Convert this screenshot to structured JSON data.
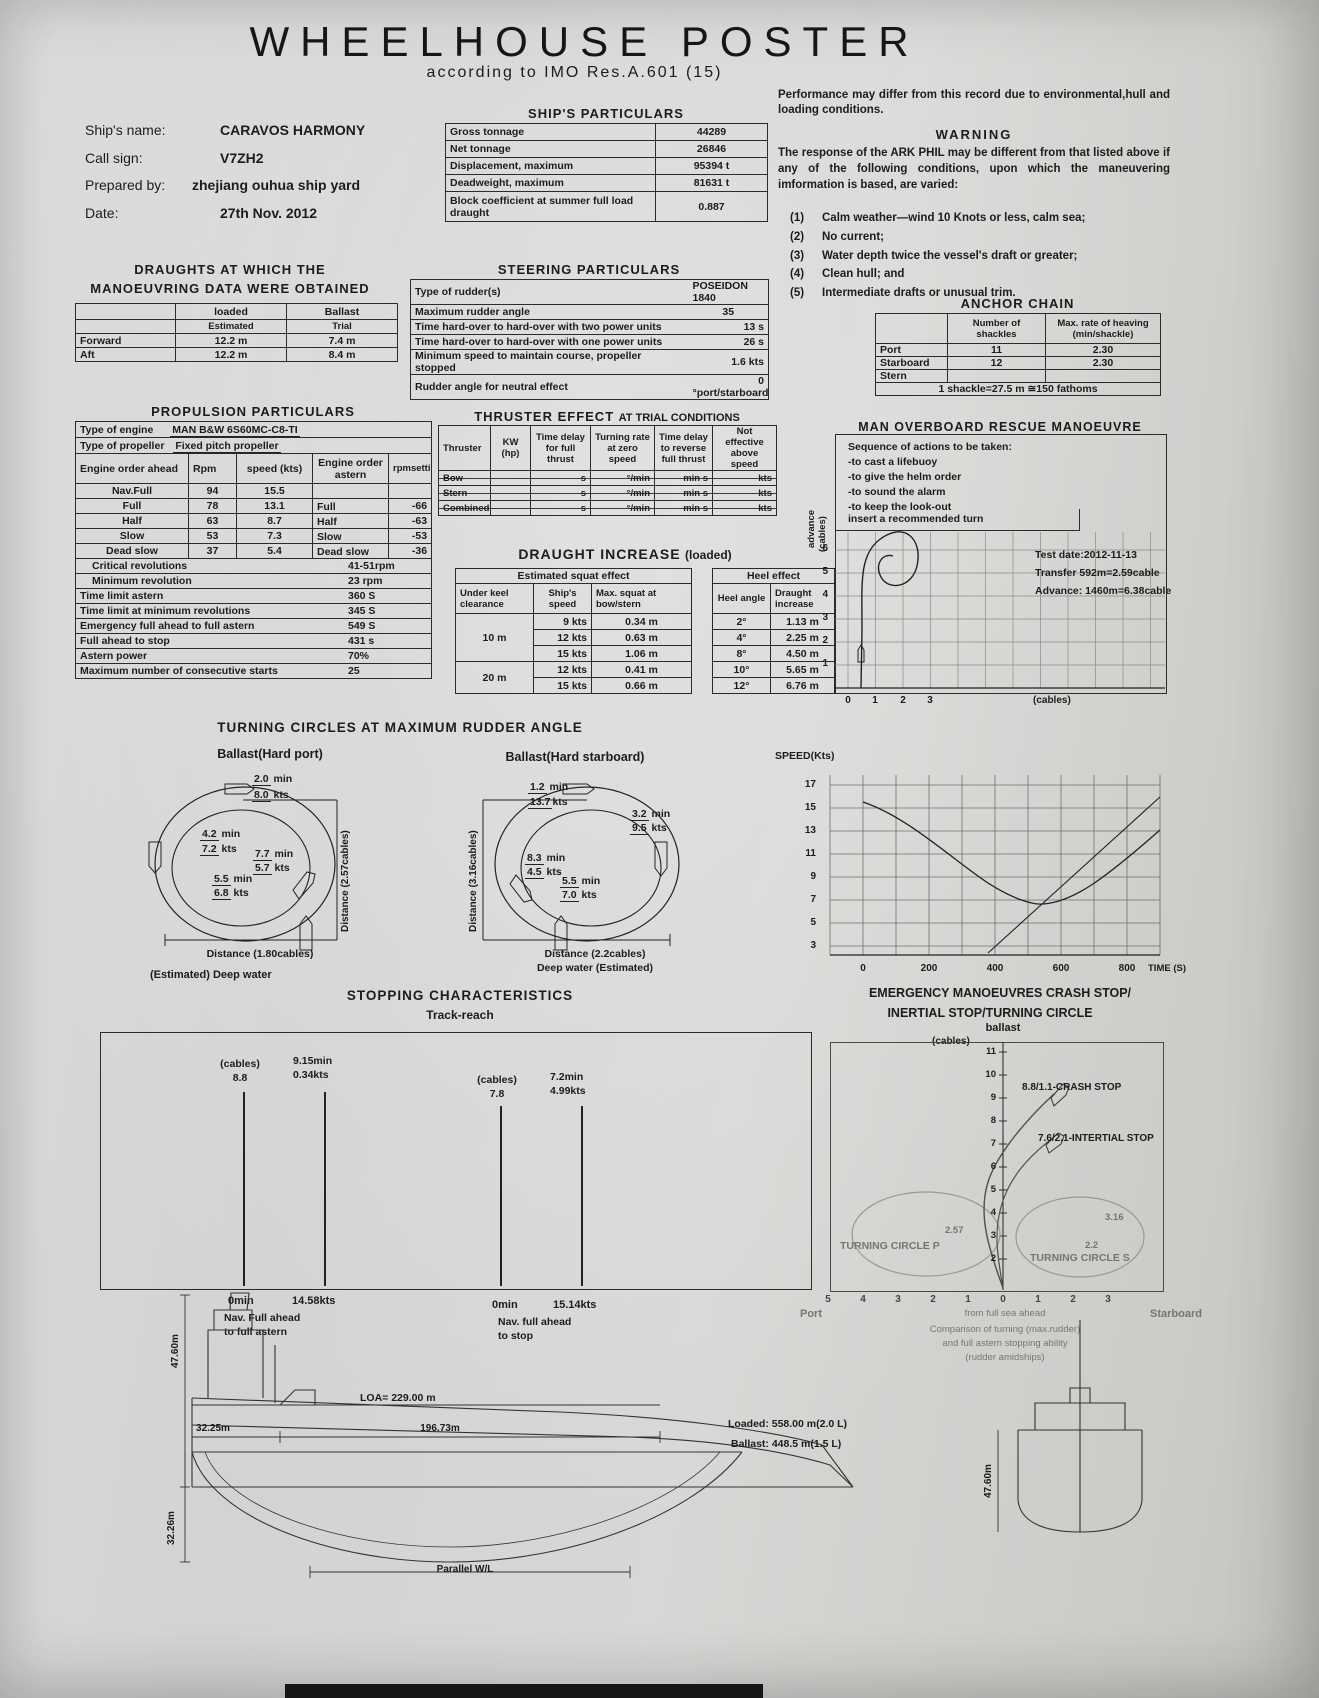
{
  "header": {
    "title": "WHEELHOUSE POSTER",
    "subtitle": "according to IMO Res.A.601 (15)"
  },
  "notes": {
    "performance": "Performance may differ from this record due to environmental,hull and loading conditions."
  },
  "ship_info": {
    "rows": [
      {
        "label": "Ship's name:",
        "value": "CARAVOS HARMONY"
      },
      {
        "label": "Call sign:",
        "value": "V7ZH2"
      },
      {
        "label": "Prepared by:",
        "value": "zhejiang ouhua ship yard"
      },
      {
        "label": "Date:",
        "value": "27th Nov. 2012"
      }
    ]
  },
  "particulars": {
    "title": "SHIP'S PARTICULARS",
    "rows": [
      {
        "label": "Gross tonnage",
        "value": "44289"
      },
      {
        "label": "Net tonnage",
        "value": "26846"
      },
      {
        "label": "Displacement, maximum",
        "value": "95394 t"
      },
      {
        "label": "Deadweight, maximum",
        "value": "81631 t"
      },
      {
        "label": "Block coefficient at summer full load draught",
        "value": "0.887"
      }
    ]
  },
  "warning": {
    "title": "WARNING",
    "body": "The response of the ARK PHIL may be different from that listed above if any of the following conditions, upon which the maneuvering imformation is based, are varied:",
    "items": [
      {
        "num": "(1)",
        "text": "Calm weather—wind 10 Knots or less, calm sea;"
      },
      {
        "num": "(2)",
        "text": "No current;"
      },
      {
        "num": "(3)",
        "text": "Water depth twice the vessel's draft or greater;"
      },
      {
        "num": "(4)",
        "text": "Clean hull; and"
      },
      {
        "num": "(5)",
        "text": "Intermediate drafts or unusual trim."
      }
    ]
  },
  "draughts": {
    "title1": "DRAUGHTS AT WHICH THE",
    "title2": "MANOEUVRING DATA WERE OBTAINED",
    "col_loaded": "loaded",
    "col_ballast": "Ballast",
    "sub_loaded": "Estimated",
    "sub_ballast": "Trial",
    "rows": [
      {
        "label": "Forward",
        "loaded": "12.2  m",
        "ballast": "7.4  m"
      },
      {
        "label": "Aft",
        "loaded": "12.2  m",
        "ballast": "8.4  m"
      }
    ]
  },
  "steering": {
    "title": "STEERING PARTICULARS",
    "rows": [
      {
        "label": "Type of rudder(s)",
        "value": "POSEIDON 1840"
      },
      {
        "label": "Maximum rudder angle",
        "value": "35"
      },
      {
        "label": "Time hard-over to hard-over with two power units",
        "value": "13  s"
      },
      {
        "label": "Time hard-over to hard-over with one power units",
        "value": "26  s"
      },
      {
        "label": "Minimum speed to maintain course, propeller stopped",
        "value": "1.6 kts"
      },
      {
        "label": "Rudder angle for neutral effect",
        "value": "0 °port/starboard"
      }
    ]
  },
  "anchor": {
    "title": "ANCHOR CHAIN",
    "col_shackles": "Number of shackles",
    "col_rate": "Max. rate of heaving (min/shackle)",
    "rows": [
      {
        "label": "Port",
        "shackles": "11",
        "rate": "2.30"
      },
      {
        "label": "Starboard",
        "shackles": "12",
        "rate": "2.30"
      },
      {
        "label": "Stern",
        "shackles": "",
        "rate": ""
      }
    ],
    "footer": "1 shackle=27.5 m ≅150 fathoms"
  },
  "propulsion": {
    "title": "PROPULSION PARTICULARS",
    "engine_label": "Type of engine",
    "engine": "MAN B&W 6S60MC-C8-TI",
    "propeller_label": "Type of propeller",
    "propeller": "Fixed pitch propeller",
    "col_ahead": "Engine order ahead",
    "col_rpm": "Rpm",
    "col_speed": "speed (kts)",
    "col_astern": "Engine order astern",
    "col_rpmset": "rpmsetting",
    "ahead_rows": [
      {
        "order": "Nav.Full",
        "rpm": "94",
        "speed": "15.5",
        "astern": "",
        "rpmset": ""
      },
      {
        "order": "Full",
        "rpm": "78",
        "speed": "13.1",
        "astern": "Full",
        "rpmset": "-66"
      },
      {
        "order": "Half",
        "rpm": "63",
        "speed": "8.7",
        "astern": "Half",
        "rpmset": "-63"
      },
      {
        "order": "Slow",
        "rpm": "53",
        "speed": "7.3",
        "astern": "Slow",
        "rpmset": "-53"
      },
      {
        "order": "Dead slow",
        "rpm": "37",
        "speed": "5.4",
        "astern": "Dead slow",
        "rpmset": "-36"
      }
    ],
    "extra_rows": [
      {
        "label": "Critical revolutions",
        "value": "41-51rpm"
      },
      {
        "label": "Minimum revolution",
        "value": "23 rpm"
      },
      {
        "label": "Time limit astern",
        "value": "360 S"
      },
      {
        "label": "Time limit at minimum revolutions",
        "value": "345 S"
      },
      {
        "label": "Emergency full ahead to full astern",
        "value": "549 S"
      },
      {
        "label": "Full ahead to stop",
        "value": "431 s"
      },
      {
        "label": "Astern power",
        "value": "70%"
      },
      {
        "label": "Maximum number of consecutive starts",
        "value": "25"
      }
    ]
  },
  "thruster": {
    "title": "THRUSTER EFFECT",
    "title2": "AT TRIAL CONDITIONS",
    "cols": [
      "Thruster",
      "KW (hp)",
      "Time delay for full thrust",
      "Turning rate at zero speed",
      "Time delay to reverse full thrust",
      "Not effective above speed"
    ],
    "rows": [
      {
        "name": "Bow",
        "delay": "s",
        "rate": "°/min",
        "reverse": "min  s",
        "speed": "kts"
      },
      {
        "name": "Stern",
        "delay": "s",
        "rate": "°/min",
        "reverse": "min  s",
        "speed": "kts"
      },
      {
        "name": "Combined",
        "delay": "s",
        "rate": "°/min",
        "reverse": "min  s",
        "speed": "kts"
      }
    ]
  },
  "di": {
    "title": "DRAUGHT INCREASE",
    "subtitle": "(loaded)",
    "squat": {
      "header": "Estimated squat effect",
      "col1": "Under keel clearance",
      "col2": "Ship's speed",
      "col3": "Max. squat at bow/stern",
      "groups": [
        {
          "ukc": "10 m",
          "rows": [
            {
              "speed": "9  kts",
              "squat": "0.34  m"
            },
            {
              "speed": "12  kts",
              "squat": "0.63  m"
            },
            {
              "speed": "15  kts",
              "squat": "1.06  m"
            }
          ]
        },
        {
          "ukc": "20 m",
          "rows": [
            {
              "speed": "12  kts",
              "squat": "0.41  m"
            },
            {
              "speed": "15  kts",
              "squat": "0.66  m"
            }
          ]
        }
      ]
    },
    "heel": {
      "header": "Heel effect",
      "col1": "Heel angle",
      "col2": "Draught increase",
      "rows": [
        {
          "angle": "2°",
          "increase": "1.13  m"
        },
        {
          "angle": "4°",
          "increase": "2.25  m"
        },
        {
          "angle": "8°",
          "increase": "4.50  m"
        },
        {
          "angle": "10°",
          "increase": "5.65  m"
        },
        {
          "angle": "12°",
          "increase": "6.76  m"
        }
      ]
    }
  },
  "mob": {
    "title": "MAN OVERBOARD RESCUE MANOEUVRE",
    "sequence_title": "Sequence of actions to be taken:",
    "actions": [
      "-to cast a lifebuoy",
      "-to give the helm order",
      "-to sound the alarm",
      "-to keep the look-out"
    ],
    "insert_label": "insert a recommended turn",
    "test_date": "Test date:2012-11-13",
    "transfer": "Transfer 592m=2.59cable",
    "advance": "Advance: 1460m=6.38cable",
    "ylabel1": "advance",
    "ylabel2": "(cables)",
    "yticks": [
      "6",
      "5",
      "4",
      "3",
      "2",
      "1"
    ],
    "xticks": [
      "0",
      "1",
      "2",
      "3"
    ],
    "xunit": "(cables)"
  },
  "speed_chart": {
    "ylabel": "SPEED(Kts)",
    "yticks": [
      "17",
      "15",
      "13",
      "11",
      "9",
      "7",
      "5",
      "3"
    ],
    "xticks": [
      "0",
      "200",
      "400",
      "600",
      "800"
    ],
    "xlabel": "TIME (S)"
  },
  "turning": {
    "title": "TURNING CIRCLES AT MAXIMUM RUDDER ANGLE",
    "min_unit": "min",
    "kts_unit": "kts",
    "port": {
      "label": "Ballast(Hard port)",
      "ann": [
        {
          "time": "2.0",
          "speed": "8.0"
        },
        {
          "time": "4.2",
          "speed": "7.2"
        },
        {
          "time": "7.7",
          "speed": "5.7"
        },
        {
          "time": "5.5",
          "speed": "6.8"
        }
      ],
      "dist_v": "Distance (2.57cables)",
      "dist_h": "Distance (1.80cables)",
      "note": "(Estimated) Deep water"
    },
    "starboard": {
      "label": "Ballast(Hard starboard)",
      "ann": [
        {
          "time": "1.2",
          "speed": "13.7"
        },
        {
          "time": "3.2",
          "speed": "9.5"
        },
        {
          "time": "8.3",
          "speed": "4.5"
        },
        {
          "time": "5.5",
          "speed": "7.0"
        }
      ],
      "dist_v": "Distance (3.16cables)",
      "dist_h": "Distance (2.2cables)",
      "note": "Deep water (Estimated)"
    }
  },
  "stopping": {
    "title": "STOPPING CHARACTERISTICS",
    "subtitle": "Track-reach",
    "left": {
      "cables_label": "(cables)",
      "cables": "8.8",
      "top_min": "9.15min",
      "top_kts": "0.34kts",
      "bottom_min": "0min",
      "bottom_kts": "14.58kts",
      "caption1": "Nav. Full ahead",
      "caption2": "to full astern"
    },
    "right": {
      "cables_label": "(cables)",
      "cables": "7.8",
      "top_min": "7.2min",
      "top_kts": "4.99kts",
      "bottom_min": "0min",
      "bottom_kts": "15.14kts",
      "caption1": "Nav. full ahead",
      "caption2": "to stop"
    }
  },
  "emergency": {
    "title1": "EMERGENCY MANOEUVRES CRASH STOP/",
    "title2": "INERTIAL STOP/TURNING CIRCLE",
    "ballast": "ballast",
    "unit": "(cables)",
    "yticks": [
      "11",
      "10",
      "9",
      "8",
      "7",
      "6",
      "5",
      "4",
      "3",
      "2"
    ],
    "crash_label": "8.8/1.1-CRASH STOP",
    "inertial_label": "7.6/2.1-INTERTIAL STOP",
    "circle_p": "TURNING  CIRCLE  P",
    "circle_s": "TURNING  CIRCLE  S",
    "fig_p": "2.57",
    "fig_s1": "3.16",
    "fig_s2": "2.2",
    "xticks": [
      "5",
      "4",
      "3",
      "2",
      "1",
      "0",
      "1",
      "2",
      "3"
    ],
    "port": "Port",
    "starboard": "Starboard",
    "center_note": "from full sea ahead",
    "caption1": "Comparison of turning (max.rudder)",
    "caption2": "and full astern stopping ability",
    "caption3": "(rudder amidships)"
  },
  "profile": {
    "height1": "47.60m",
    "loa": "LOA= 229.00 m",
    "loaded": "Loaded: 558.00 m(2.0 L)",
    "ballast": "Ballast: 448.5  m(1.5 L)",
    "dim1": "32.25m",
    "dim2": "196.73m",
    "dim3": "32.26m",
    "parallel": "Parallel W/L",
    "height2": "47.60m"
  },
  "chart_data": [
    {
      "type": "line",
      "title": "Speed decay after engine order (trial)",
      "xlabel": "TIME (S)",
      "ylabel": "SPEED(Kts)",
      "xlim": [
        0,
        1000
      ],
      "yticks": [
        3,
        5,
        7,
        9,
        11,
        13,
        15,
        17
      ],
      "xticks": [
        0,
        200,
        400,
        600,
        800
      ],
      "series": [
        {
          "name": "speed",
          "points": [
            [
              0,
              15.5
            ],
            [
              100,
              13.8
            ],
            [
              200,
              11.5
            ],
            [
              300,
              9.3
            ],
            [
              400,
              7.8
            ],
            [
              450,
              7.2
            ],
            [
              550,
              7.5
            ],
            [
              650,
              8.6
            ],
            [
              800,
              10.5
            ]
          ]
        }
      ],
      "grid": true,
      "legend": "none"
    },
    {
      "type": "line",
      "title": "Man overboard recommended turn track",
      "xlabel": "(cables)",
      "ylabel": "advance (cables)",
      "xticks": [
        0,
        1,
        2,
        3
      ],
      "yticks": [
        1,
        2,
        3,
        4,
        5,
        6
      ],
      "annotations": [
        "Test date:2012-11-13",
        "Transfer 592m=2.59cable",
        "Advance: 1460m=6.38cable"
      ],
      "grid": true
    },
    {
      "type": "line",
      "title": "Emergency manoeuvres crash stop/inertial stop/turning circle (ballast, cables)",
      "xticks": [
        -5,
        -4,
        -3,
        -2,
        -1,
        0,
        1,
        2,
        3
      ],
      "yticks": [
        2,
        3,
        4,
        5,
        6,
        7,
        8,
        9,
        10,
        11
      ],
      "annotations": [
        "8.8/1.1-CRASH STOP",
        "7.6/2.1-INTERTIAL STOP",
        "TURNING CIRCLE P",
        "TURNING CIRCLE S",
        "2.57",
        "3.16",
        "2.2"
      ],
      "grid": false
    }
  ]
}
